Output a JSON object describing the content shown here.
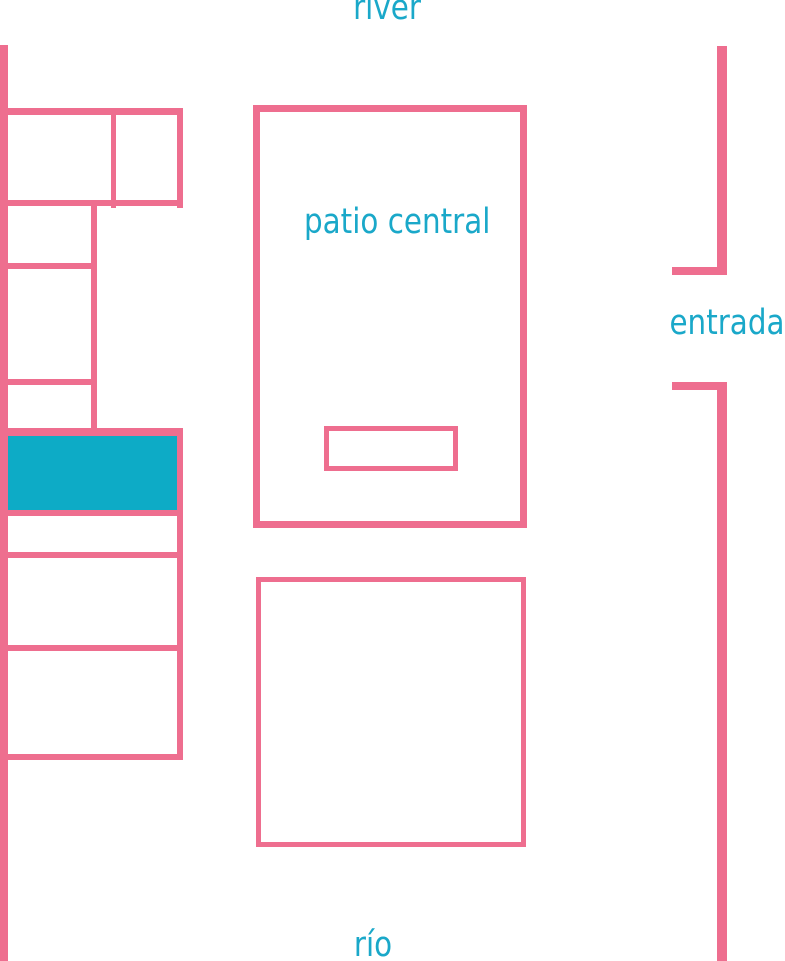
{
  "palette": {
    "background": "#ffffff",
    "wall_pink": "#ee6e8f",
    "room_highlight_teal": "#0dabc6",
    "label_teal": "#1aa8c9"
  },
  "labels": {
    "river_top": "river",
    "river_bottom": "río",
    "central_courtyard": "patio central",
    "entrance": "entrada"
  }
}
